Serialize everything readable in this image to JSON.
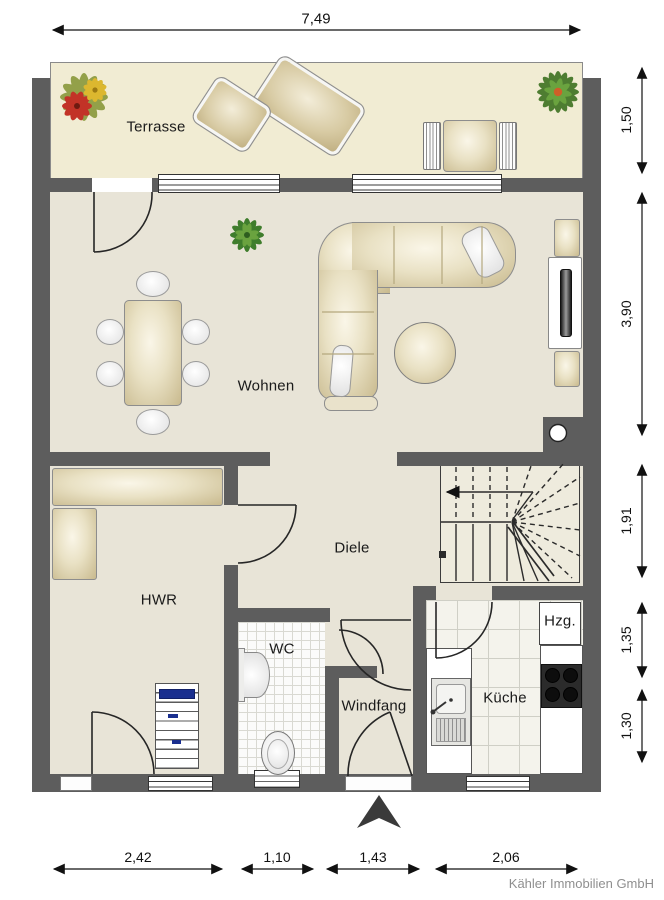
{
  "rooms": {
    "terrasse": "Terrasse",
    "wohnen": "Wohnen",
    "diele": "Diele",
    "hwr": "HWR",
    "wc": "WC",
    "windfang": "Windfang",
    "kueche": "Küche",
    "hzg": "Hzg."
  },
  "dimensions": {
    "top": "7,49",
    "right": [
      "1,50",
      "3,90",
      "1,91",
      "1,35",
      "1,30"
    ],
    "bottom": [
      "2,42",
      "1,10",
      "1,43",
      "2,06"
    ]
  },
  "footer": {
    "company": "Kähler Immobilien GmbH"
  },
  "colors": {
    "wall": "#5d5d5d",
    "terrace_floor": "#f1ecd3",
    "interior_floor": "#e8e4d7",
    "stairs_floor": "#eeebdd",
    "furniture_beige": "#d8cba0",
    "accent_navy": "#1a2f8f",
    "plant_green": "#4e7d31",
    "flower_red": "#c13327",
    "flower_yellow": "#debc30"
  },
  "icons": {
    "north_arrow": "▲",
    "plants": [
      "flower-icon",
      "plant-icon"
    ]
  }
}
